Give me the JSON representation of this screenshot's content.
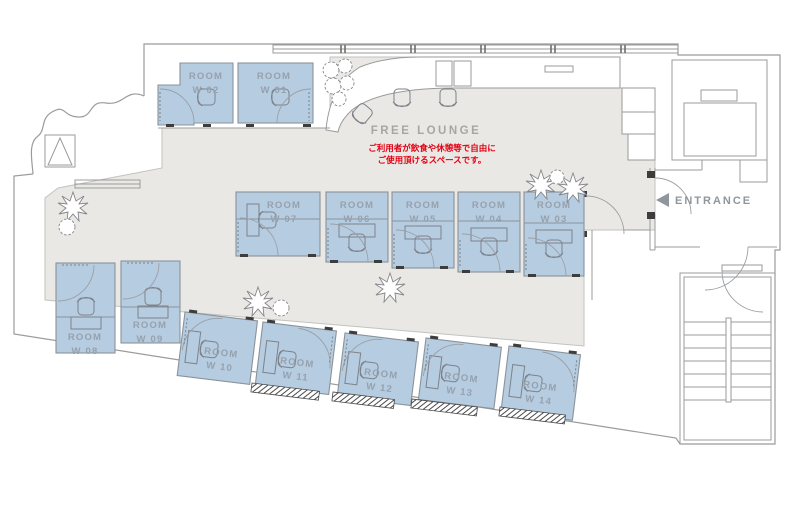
{
  "colors": {
    "room_fill": "#b6cce1",
    "room_stroke": "#8a939b",
    "corridor_fill": "#e9e8e5",
    "wall": "#9b9b9b",
    "label": "#96a1ad",
    "lounge_label": "#a6a6a6",
    "accent_red": "#e50012",
    "dark_tick": "#3d3d3d"
  },
  "lounge": {
    "label": "FREE LOUNGE",
    "note_line1": "ご利用者が飲食や休憩等で自由に",
    "note_line2": "ご使用頂けるスペースです。"
  },
  "entrance": {
    "label": "ENTRANCE"
  },
  "rooms": [
    {
      "name": "ROOM",
      "number": "W 01"
    },
    {
      "name": "ROOM",
      "number": "W 02"
    },
    {
      "name": "ROOM",
      "number": "W 03"
    },
    {
      "name": "ROOM",
      "number": "W 04"
    },
    {
      "name": "ROOM",
      "number": "W 05"
    },
    {
      "name": "ROOM",
      "number": "W 06"
    },
    {
      "name": "ROOM",
      "number": "W 07"
    },
    {
      "name": "ROOM",
      "number": "W 08"
    },
    {
      "name": "ROOM",
      "number": "W 09"
    },
    {
      "name": "ROOM",
      "number": "W 10"
    },
    {
      "name": "ROOM",
      "number": "W 11"
    },
    {
      "name": "ROOM",
      "number": "W 12"
    },
    {
      "name": "ROOM",
      "number": "W 13"
    },
    {
      "name": "ROOM",
      "number": "W 14"
    }
  ]
}
